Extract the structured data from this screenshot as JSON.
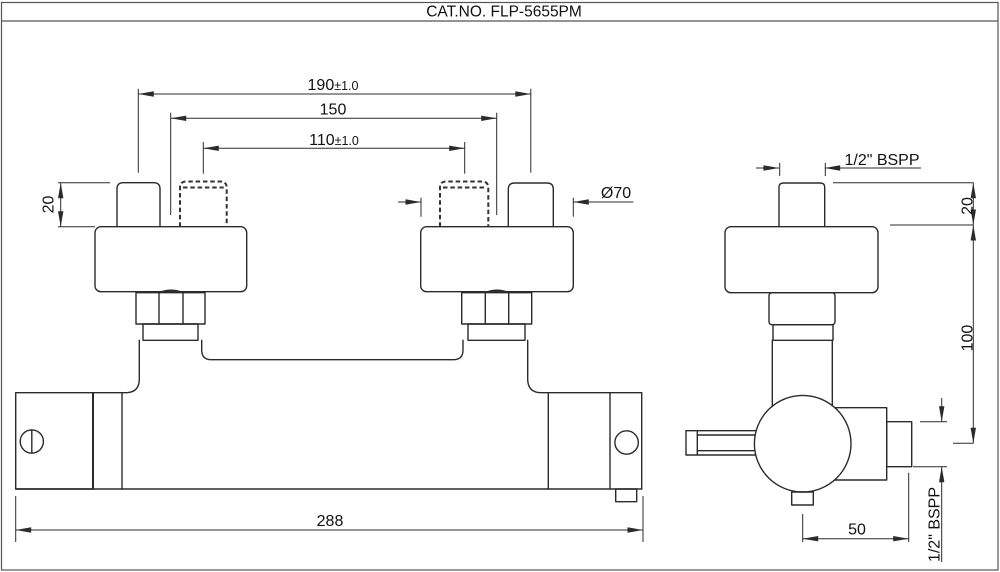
{
  "title": "CAT.NO. FLP-5655PM",
  "drawing": {
    "type": "technical-dimension-drawing",
    "views": [
      "front-view",
      "side-view"
    ]
  },
  "dimensions": {
    "front": {
      "connector_spacing_wide": {
        "value": "190",
        "tolerance": "±1.0"
      },
      "flange_center_spacing": "150",
      "connector_spacing_narrow": {
        "value": "110",
        "tolerance": "±1.0"
      },
      "connector_height": "20",
      "flange_diameter": "Ø70",
      "body_length": "288"
    },
    "side": {
      "inlet_thread": "1/2\" BSPP",
      "connector_height": "20",
      "inlet_to_center": "100",
      "center_to_outlet": "50",
      "outlet_thread": "1/2\" BSPP"
    }
  },
  "colors": {
    "line": "#2b2b2b",
    "background": "#ffffff"
  }
}
